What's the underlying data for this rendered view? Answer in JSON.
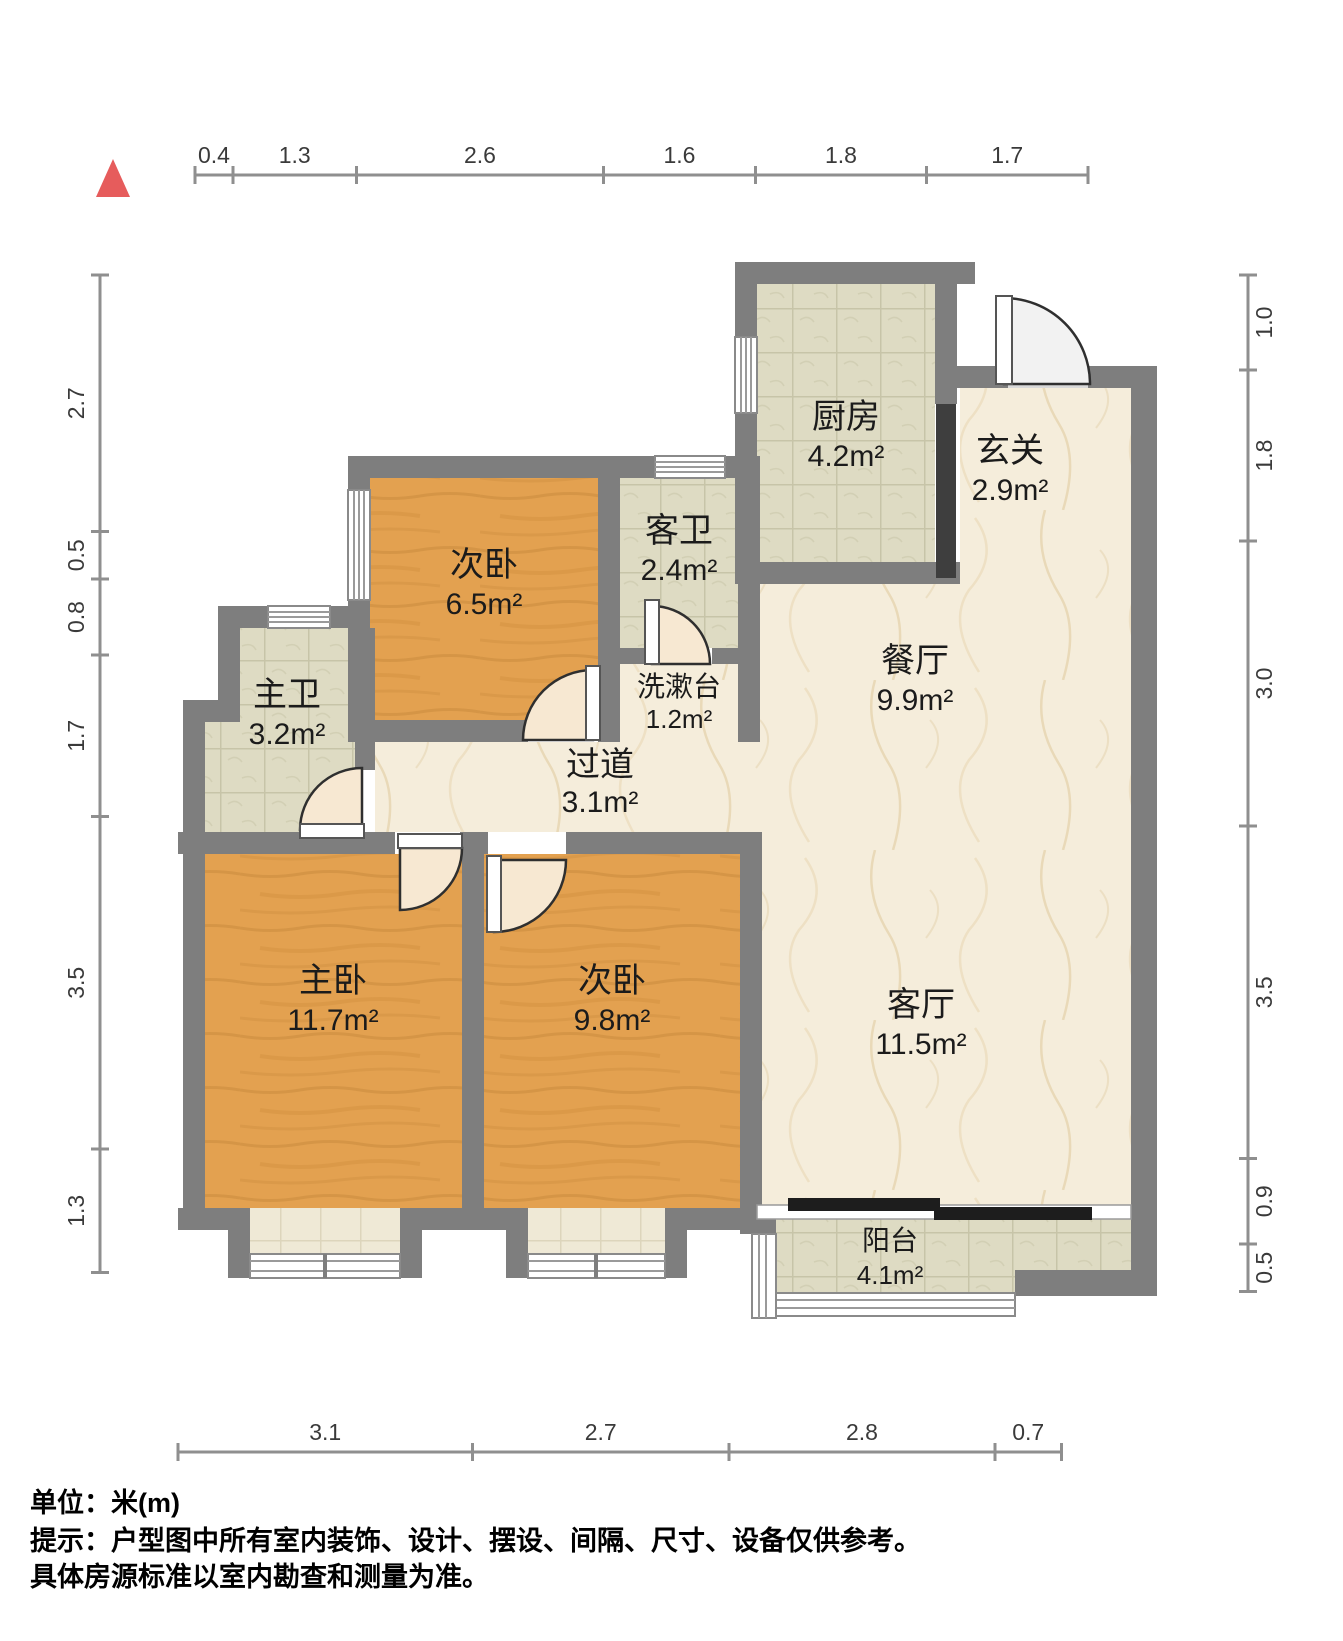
{
  "colors": {
    "north_marker": "#e65c5c",
    "wall": "#7e7e7e",
    "wood_floor": "#e3a150",
    "marble_floor": "#f5eddb",
    "tile_floor": "#dedbc3",
    "dark_divider": "#3e3e3e"
  },
  "dimensions": {
    "top": [
      "0.4",
      "1.3",
      "2.6",
      "1.6",
      "1.8",
      "1.7"
    ],
    "bottom": [
      "3.1",
      "2.7",
      "2.8",
      "0.7"
    ],
    "left": [
      "2.7",
      "0.5",
      "0.8",
      "1.7",
      "3.5",
      "1.3"
    ],
    "right": [
      "1.0",
      "1.8",
      "3.0",
      "3.5",
      "0.9",
      "0.5"
    ]
  },
  "rooms": [
    {
      "name": "厨房",
      "area": "4.2m²"
    },
    {
      "name": "玄关",
      "area": "2.9m²"
    },
    {
      "name": "客卫",
      "area": "2.4m²"
    },
    {
      "name": "次卧",
      "area": "6.5m²"
    },
    {
      "name": "洗漱台",
      "area": "1.2m²"
    },
    {
      "name": "餐厅",
      "area": "9.9m²"
    },
    {
      "name": "主卫",
      "area": "3.2m²"
    },
    {
      "name": "过道",
      "area": "3.1m²"
    },
    {
      "name": "主卧",
      "area": "11.7m²"
    },
    {
      "name": "次卧",
      "area": "9.8m²"
    },
    {
      "name": "客厅",
      "area": "11.5m²"
    },
    {
      "name": "阳台",
      "area": "4.1m²"
    }
  ],
  "footer": {
    "line1": "单位：米(m)",
    "line2": "提示：户型图中所有室内装饰、设计、摆设、间隔、尺寸、设备仅供参考。",
    "line3": "具体房源标准以室内勘查和测量为准。"
  }
}
